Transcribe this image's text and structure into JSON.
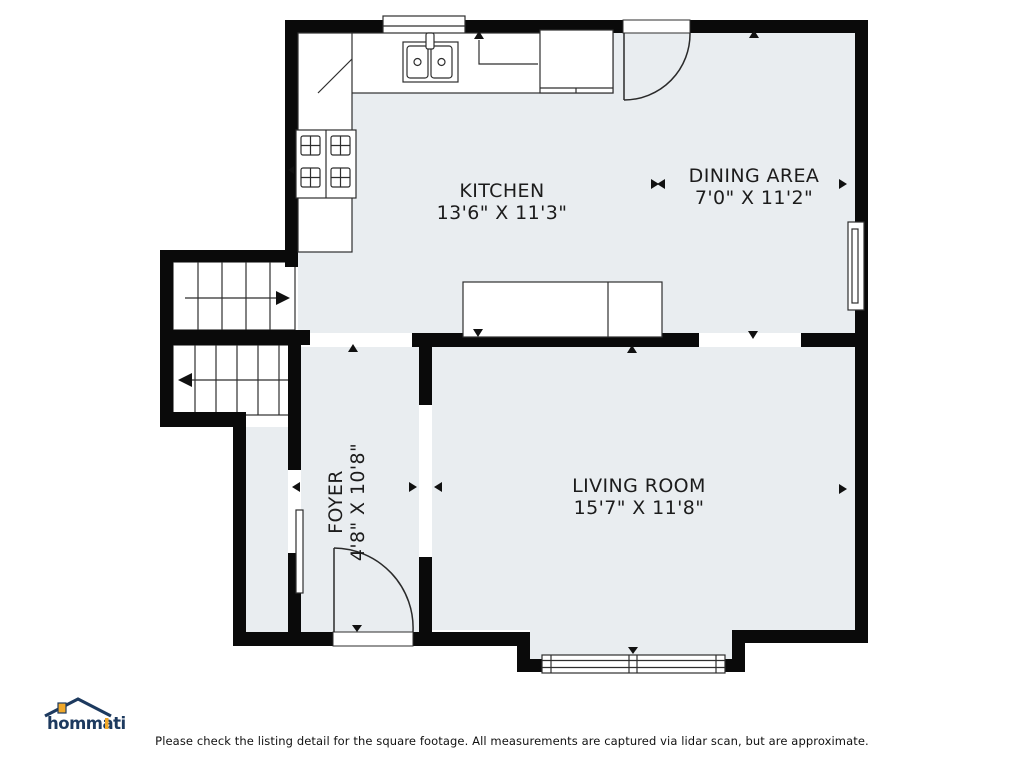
{
  "rooms": [
    {
      "name": "KITCHEN",
      "dims": "13'6\" X 11'3\""
    },
    {
      "name": "DINING AREA",
      "dims": "7'0\" X 11'2\""
    },
    {
      "name": "LIVING ROOM",
      "dims": "15'7\" X 11'8\""
    },
    {
      "name": "FOYER",
      "dims": "4'8\" X 10'8\""
    }
  ],
  "footer": {
    "disclaimer": "Please check the listing detail for the square footage. All measurements are captured via lidar scan, but are approximate."
  },
  "logo": {
    "brand": "hommati"
  },
  "colors": {
    "floor": "#e9edf0",
    "wall": "#0a0a0a",
    "label_text": "#1c1c1c",
    "logo_navy": "#1d3a5f",
    "logo_gold": "#f0a82a"
  }
}
